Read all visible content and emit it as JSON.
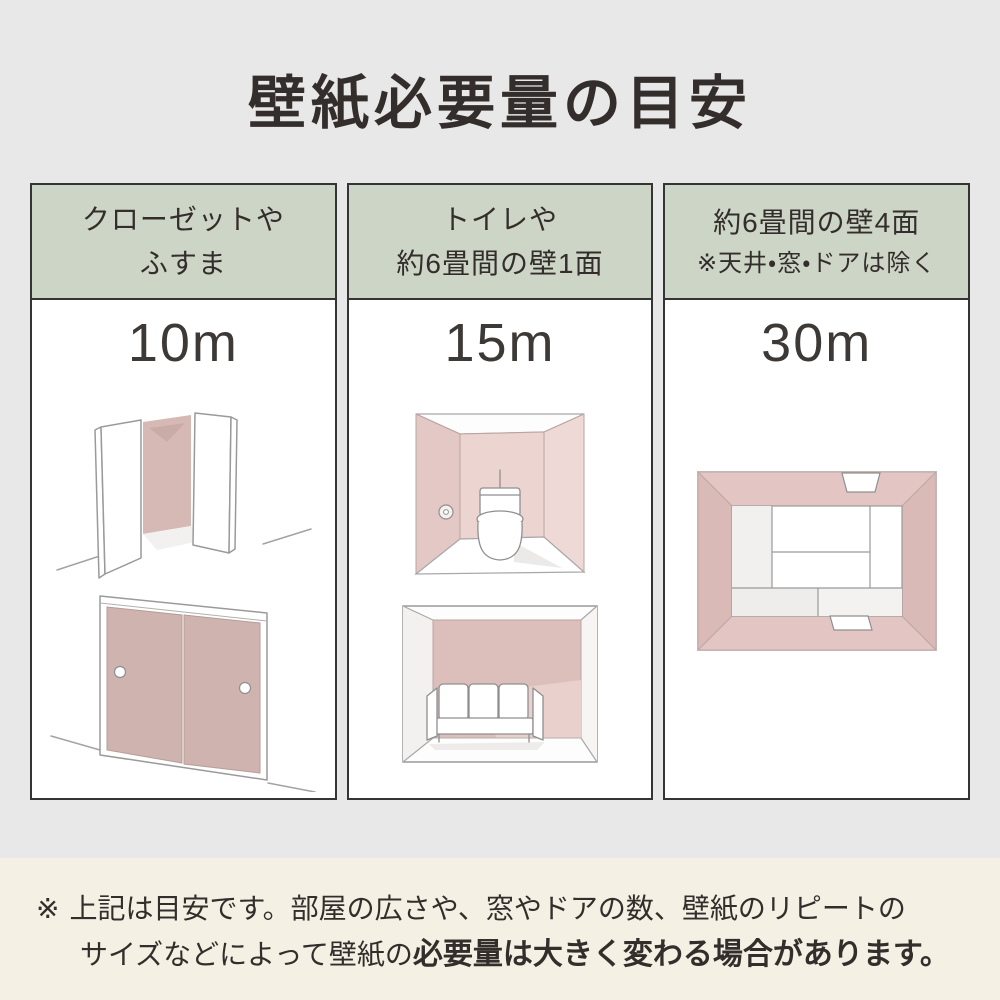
{
  "page": {
    "title": "壁紙必要量の目安"
  },
  "columns": [
    {
      "header_lines": [
        "クローゼットや",
        "ふすま"
      ],
      "amount": "10m",
      "illustrations": [
        "closet-open-doors",
        "fusuma-sliding-doors"
      ]
    },
    {
      "header_lines": [
        "トイレや",
        "約6畳間の壁1面"
      ],
      "amount": "15m",
      "illustrations": [
        "toilet-room",
        "room-one-wall-with-sofa"
      ]
    },
    {
      "header_lines": [
        "約6畳間の壁4面",
        "※天井・窓・ドアは除く"
      ],
      "amount": "30m",
      "illustrations": [
        "tatami-room-overhead"
      ]
    }
  ],
  "footnote": {
    "marker": "※",
    "line1": "上記は目安です。部屋の広さや、窓やドアの数、壁紙のリピートの",
    "line2_regular": "サイズなどによって壁紙の",
    "line2_bold": "必要量は大きく変わる場合があります。"
  },
  "colors": {
    "background_top": "#e8e8e8",
    "background_note": "#f5f0e4",
    "header_green": "#ccd5c6",
    "border_dark": "#343434",
    "text_dark": "#332e2b",
    "wallpaper_pink": "#d6b9b4",
    "wallpaper_pink_deep": "#cfb3ae",
    "wallpaper_pink_light": "#ecd4d1"
  }
}
